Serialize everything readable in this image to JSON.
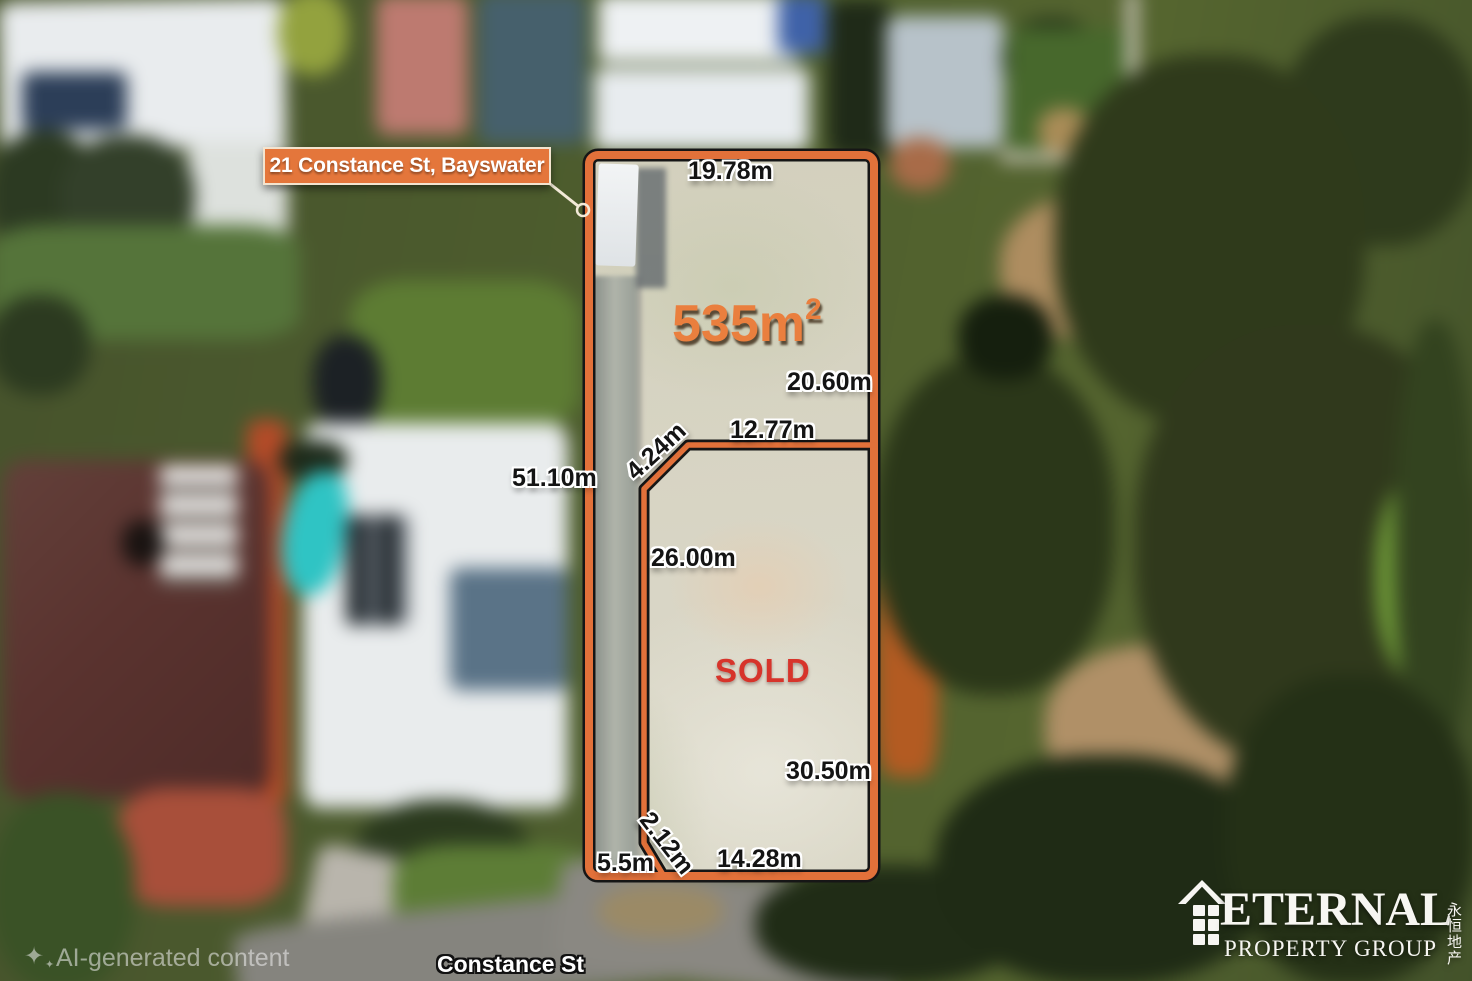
{
  "address_label": "21 Constance St, Bayswater",
  "lot": {
    "area": {
      "value": "535m",
      "superscript": "2"
    },
    "status": "SOLD",
    "measurements": {
      "top": "19.78m",
      "right_upper": "20.60m",
      "divider_horizontal": "12.77m",
      "divider_diagonal": "4.24m",
      "left": "51.10m",
      "divider_vertical": "26.00m",
      "right_lower": "30.50m",
      "bottom_diagonal": "2.12m",
      "bottom_left": "5.5m",
      "bottom": "14.28m"
    }
  },
  "street": "Constance St",
  "watermark": "AI-generated content",
  "branding": {
    "name": "ETERNAL",
    "subtitle": "PROPERTY GROUP",
    "chinese": "永恒地产"
  },
  "colors": {
    "boundary_orange": "#E2713A",
    "label_box_orange": "#E4763B",
    "area_text_orange": "#EA7F3E",
    "sold_red": "#D7342B",
    "measurement_text": "#141414",
    "label_text_white": "#FFFFFF"
  }
}
